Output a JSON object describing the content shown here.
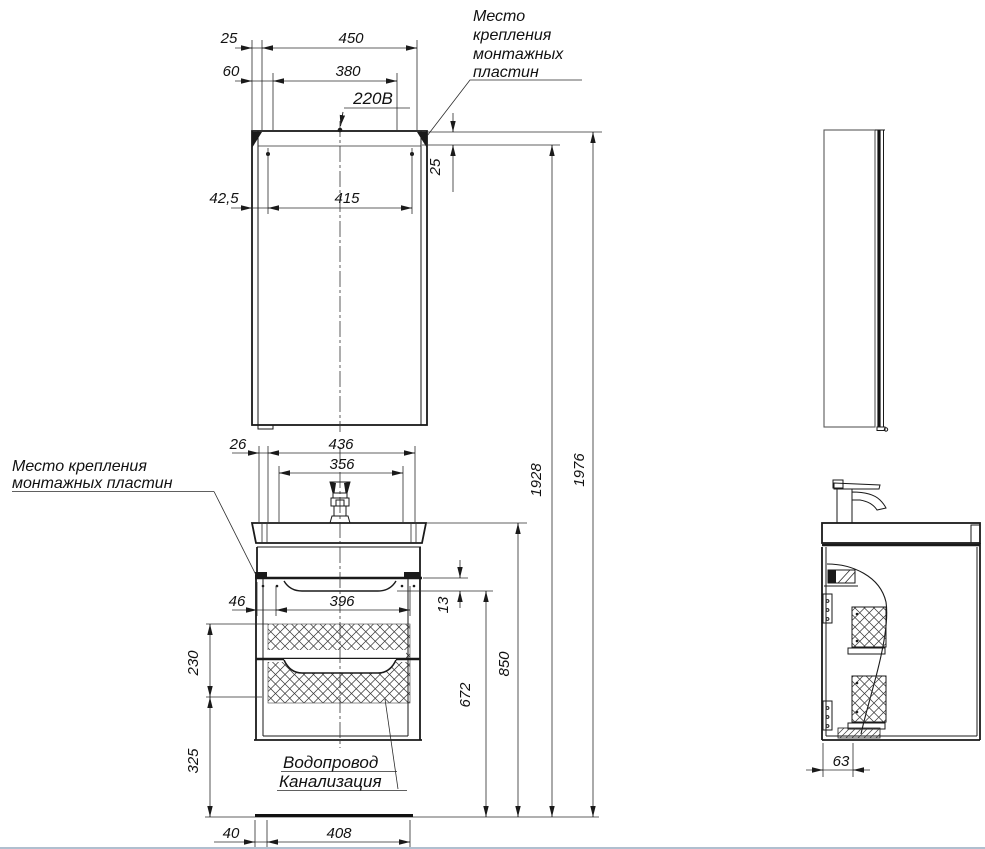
{
  "annotations": {
    "power_outlet": "220В",
    "mounting_plates_top": [
      "Место",
      "крепления",
      "монтажных",
      "пластин"
    ],
    "mounting_plates_left": [
      "Место крепления",
      "монтажных пластин"
    ],
    "water_supply": "Водопровод",
    "sewerage": "Канализация"
  },
  "dims": {
    "mirror_top": {
      "edge_offset": "25",
      "width": "450",
      "offset2": "60",
      "plates_span": "380",
      "plate_left": "42,5",
      "plate_span": "415",
      "plate_drop": "25"
    },
    "vanity_top": {
      "edge_offset": "26",
      "width": "436",
      "plates_span": "356"
    },
    "vanity_mid": {
      "drawer_offset": "46",
      "drawer_width": "396",
      "sink_gap": "13"
    },
    "left_column": {
      "zone_height": "230",
      "zone_clearance": "325"
    },
    "right_column": {
      "drain_height": "672",
      "counter_height": "850",
      "plates_height": "1928",
      "total_height": "1976"
    },
    "bottom": {
      "zone_offset": "40",
      "zone_width": "408"
    },
    "side_view": {
      "front_offset": "63"
    }
  },
  "colors": {
    "line": "#1a1a1a",
    "background": "#ffffff"
  }
}
